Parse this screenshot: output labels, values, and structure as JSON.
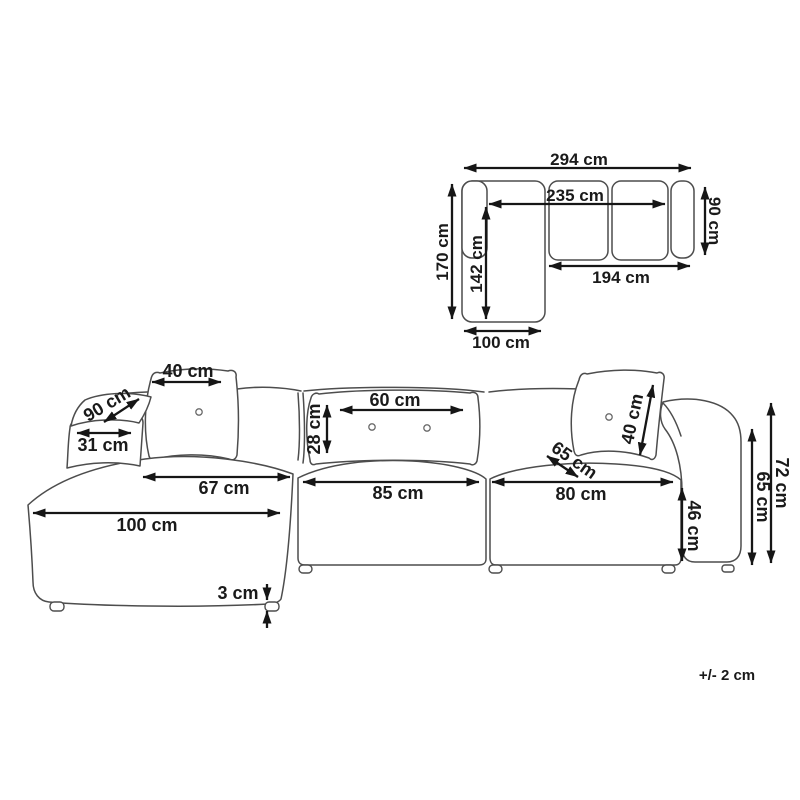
{
  "colors": {
    "background": "#ffffff",
    "sofa_outline": "#4d4d4d",
    "dimension_line": "#161616",
    "label_text": "#1a1a1a"
  },
  "plan_view": {
    "description": "top view of L-shaped sectional sofa",
    "dimensions": {
      "overall_width": "294 cm",
      "inner_width": "235 cm",
      "side_depth": "90 cm",
      "overall_depth": "170 cm",
      "chaise_inner_length": "142 cm",
      "seat_front_length": "194 cm",
      "chaise_width": "100 cm"
    }
  },
  "front_view": {
    "description": "front perspective view of modular sofa with chaise",
    "dimensions": {
      "left_cushion_width": "40 cm",
      "left_arm_length": "90 cm",
      "left_arm_width": "31 cm",
      "left_seat_width": "67 cm",
      "chaise_length": "100 cm",
      "foot_height": "3 cm",
      "center_cushion_width": "60 cm",
      "center_cushion_height": "28 cm",
      "center_seat_width": "85 cm",
      "right_seat_width": "80 cm",
      "seat_depth": "65 cm",
      "right_cushion_width": "40 cm",
      "seat_height": "46 cm",
      "arm_height": "65 cm",
      "total_height": "72 cm"
    }
  },
  "footnote": {
    "tolerance": "+/- 2 cm"
  }
}
